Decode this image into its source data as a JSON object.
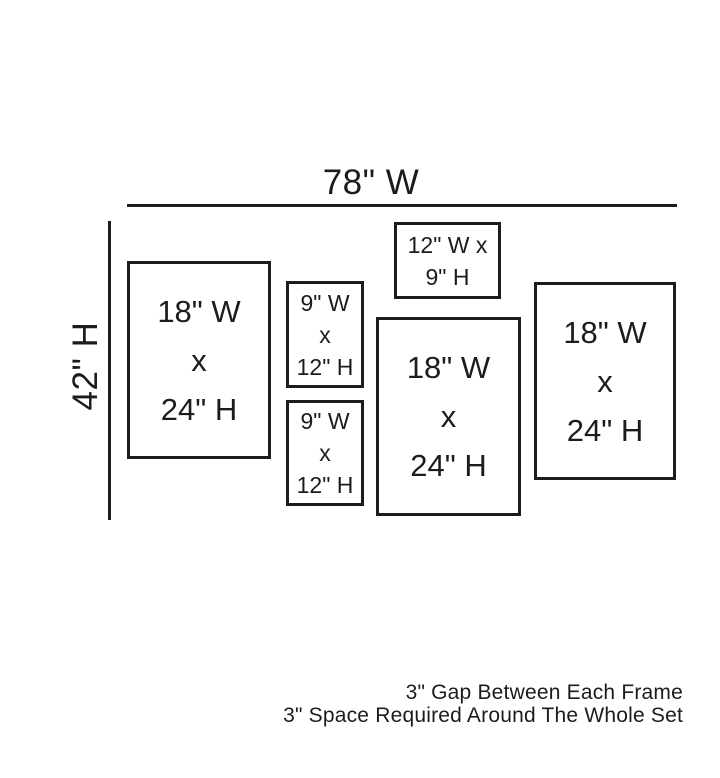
{
  "colors": {
    "ink": "#1c1c1c",
    "background": "#ffffff"
  },
  "diagram": {
    "total_width_label": "78\" W",
    "total_height_label": "42\" H",
    "frames": [
      {
        "name": "frame-18x24-left",
        "width_in": 18,
        "height_in": 24,
        "lines": [
          "18\" W",
          "x",
          "24\" H"
        ]
      },
      {
        "name": "frame-9x12-upper",
        "width_in": 9,
        "height_in": 12,
        "lines": [
          "9\" W",
          "x",
          "12\" H"
        ]
      },
      {
        "name": "frame-9x12-lower",
        "width_in": 9,
        "height_in": 12,
        "lines": [
          "9\" W",
          "x",
          "12\" H"
        ]
      },
      {
        "name": "frame-12x9",
        "width_in": 12,
        "height_in": 9,
        "lines": [
          "12\" W x",
          "9\" H"
        ]
      },
      {
        "name": "frame-18x24-center",
        "width_in": 18,
        "height_in": 24,
        "lines": [
          "18\" W",
          "x",
          "24\" H"
        ]
      },
      {
        "name": "frame-18x24-right",
        "width_in": 18,
        "height_in": 24,
        "lines": [
          "18\" W",
          "x",
          "24\" H"
        ]
      }
    ],
    "notes": [
      "3\" Gap Between Each Frame",
      "3\" Space Required Around The Whole Set"
    ]
  }
}
